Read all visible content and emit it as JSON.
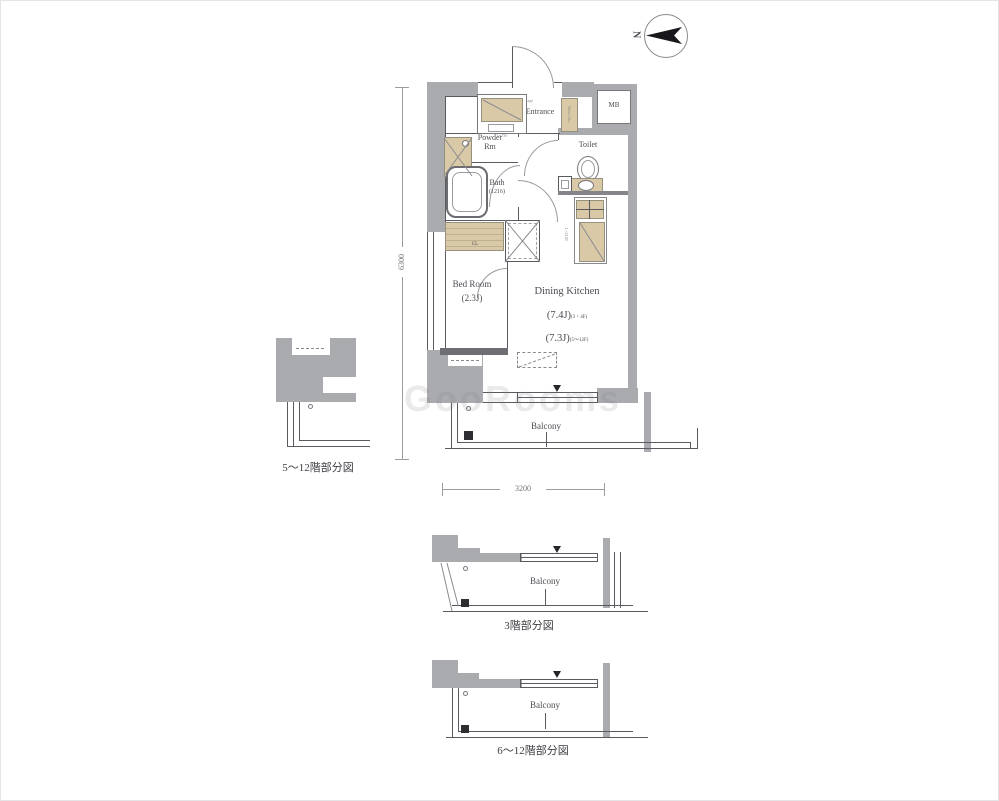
{
  "colors": {
    "wall": "#aaabaf",
    "fixture_tan": "#d9c9a6",
    "line": "#5a5b60",
    "ink": "#4c4d53",
    "dim": "#707075"
  },
  "compass": {
    "north": "N"
  },
  "watermark": {
    "text": "GooRooms"
  },
  "plan": {
    "entrance": "Entrance",
    "entrance_storage": "Storage",
    "shoes_clo": "Shoes Clo",
    "mb": "MB",
    "powder1": "Powder",
    "powder2": "Rm",
    "bath": "Bath",
    "bath_size": "(1216)",
    "toilet": "Toilet",
    "bedroom": "Bed Room",
    "bedroom_size": "(2.3J)",
    "dining": "Dining Kitchen",
    "area1": "(7.4J)",
    "area1_floors": "(3・4F)",
    "area2": "(7.3J)",
    "area2_floors": "(5〜12F)",
    "closet": "CL",
    "balcony": "Balcony",
    "vanity_len": "L=750",
    "kitchen_len": "L=2100",
    "dim_height": "6300",
    "dim_width": "3200"
  },
  "subplans": {
    "left": {
      "caption": "5〜12階部分図"
    },
    "mid": {
      "caption": "3階部分図",
      "balcony": "Balcony"
    },
    "bottom": {
      "caption": "6〜12階部分図",
      "balcony": "Balcony"
    }
  }
}
